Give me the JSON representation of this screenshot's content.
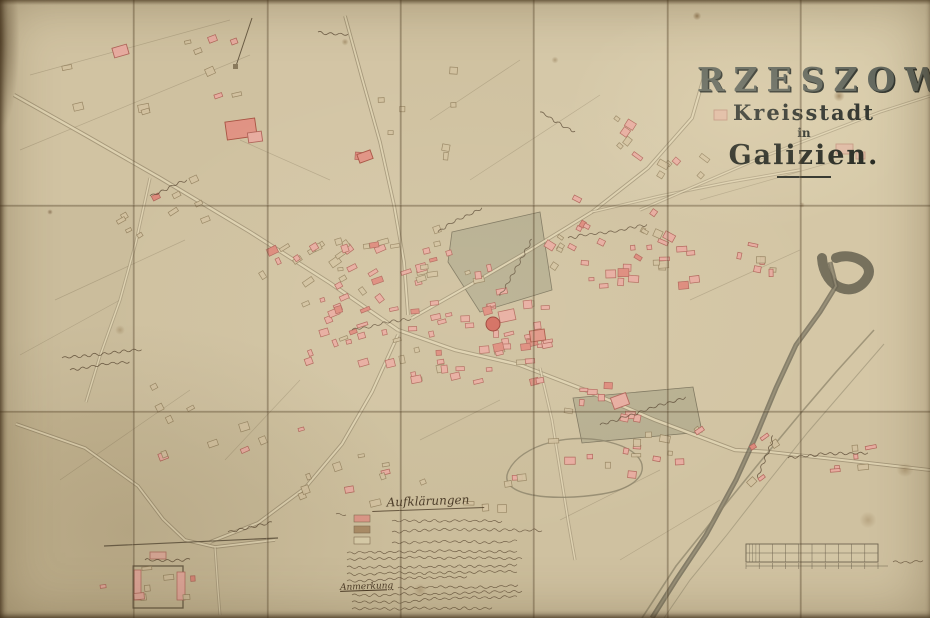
{
  "title": {
    "city": "RZESZOW",
    "subtitle": "Kreisstadt",
    "connector": "in",
    "region": "Galizien."
  },
  "legend": {
    "title": "Aufklärungen",
    "note_label": "Anmerkung",
    "swatches": [
      {
        "name": "masonry-building-swatch",
        "color": "#dd9486"
      },
      {
        "name": "wooden-building-swatch",
        "color": "#a98a64"
      },
      {
        "name": "outline-parcel-swatch",
        "color": "#d9cdaa"
      }
    ],
    "swatch_geo": [
      [
        354,
        515
      ],
      [
        354,
        526
      ],
      [
        354,
        537
      ]
    ],
    "lines": [
      [
        336,
        514,
        8
      ],
      [
        392,
        521,
        110
      ],
      [
        392,
        532,
        150
      ],
      [
        392,
        543,
        125
      ],
      [
        347,
        553,
        172
      ],
      [
        347,
        560,
        176
      ],
      [
        347,
        567,
        170
      ],
      [
        347,
        574,
        168
      ],
      [
        347,
        581,
        120
      ]
    ],
    "note_lines": [
      [
        398,
        588,
        118
      ],
      [
        352,
        595,
        168
      ],
      [
        352,
        602,
        166
      ],
      [
        352,
        609,
        140
      ]
    ]
  },
  "scale_bar": {
    "x": 746,
    "y": 544,
    "w": 132,
    "h": 18,
    "cols": 10,
    "label": [
      893,
      562,
      32
    ]
  },
  "colors": {
    "paper": "#cec09f",
    "ink": "#55432e",
    "road_fill": "#e3d7b6",
    "road_edge": "#8f8166",
    "river": "#6b6654",
    "stream": "#8a8168",
    "park": "#b2aa8d",
    "park_edge": "#7d755e",
    "masonry_fill": "#e7aca0",
    "masonry_edge": "#b0655a",
    "masonry_dark": "#dd8a7c",
    "wood_fill": "#d3c2a0",
    "wood_edge": "#93805e",
    "church_fill": "#d2685c",
    "church_edge": "#993c31"
  },
  "paper": {
    "cols": [
      0,
      133,
      267,
      400,
      533,
      667,
      800,
      930
    ],
    "rows": [
      0,
      205,
      411,
      618
    ],
    "panel_tints": [
      "#d1c3a2",
      "#cfc1a0",
      "#d3c5a5",
      "#d0c2a1",
      "#d5c8a8",
      "#d3c5a4",
      "#d7caa9",
      "#cbbd9c",
      "#cfc1a0",
      "#d1c3a2",
      "#cdbf9e",
      "#d0c2a1",
      "#d3c5a4",
      "#d5c7a6",
      "#c3b491",
      "#c9bb99",
      "#cdbf9d",
      "#cbbd9b",
      "#cfc1a0",
      "#d1c3a2",
      "#cfc1a0"
    ]
  },
  "map": {
    "roads": [
      {
        "pts": [
          [
            14,
            95
          ],
          [
            85,
            135
          ],
          [
            160,
            178
          ],
          [
            250,
            232
          ],
          [
            330,
            283
          ],
          [
            398,
            330
          ]
        ],
        "w": 3
      },
      {
        "pts": [
          [
            398,
            330
          ],
          [
            455,
            350
          ],
          [
            520,
            365
          ],
          [
            585,
            390
          ],
          [
            655,
            420
          ],
          [
            735,
            450
          ],
          [
            770,
            452
          ]
        ],
        "w": 3
      },
      {
        "pts": [
          [
            770,
            452
          ],
          [
            860,
            462
          ],
          [
            930,
            470
          ]
        ],
        "w": 2.6
      },
      {
        "pts": [
          [
            412,
            318
          ],
          [
            470,
            285
          ],
          [
            530,
            250
          ],
          [
            592,
            212
          ],
          [
            648,
            168
          ],
          [
            692,
            118
          ],
          [
            706,
            70
          ]
        ],
        "w": 2.6
      },
      {
        "pts": [
          [
            592,
            212
          ],
          [
            660,
            196
          ],
          [
            730,
            182
          ],
          [
            800,
            170
          ]
        ],
        "w": 2,
        "faint": 1
      },
      {
        "pts": [
          [
            640,
            210
          ],
          [
            760,
            158
          ],
          [
            880,
            112
          ],
          [
            930,
            96
          ]
        ],
        "w": 2,
        "faint": 1
      },
      {
        "pts": [
          [
            345,
            16
          ],
          [
            362,
            78
          ],
          [
            380,
            142
          ],
          [
            394,
            205
          ],
          [
            404,
            262
          ],
          [
            408,
            315
          ]
        ],
        "w": 2.4
      },
      {
        "pts": [
          [
            398,
            335
          ],
          [
            372,
            392
          ],
          [
            342,
            444
          ],
          [
            305,
            488
          ],
          [
            258,
            523
          ],
          [
            210,
            542
          ]
        ],
        "w": 2.6
      },
      {
        "pts": [
          [
            16,
            424
          ],
          [
            85,
            448
          ],
          [
            138,
            486
          ],
          [
            163,
            519
          ],
          [
            185,
            540
          ],
          [
            215,
            547
          ],
          [
            275,
            540
          ]
        ],
        "w": 2.4
      },
      {
        "pts": [
          [
            150,
            178
          ],
          [
            136,
            242
          ],
          [
            120,
            300
          ],
          [
            100,
            356
          ],
          [
            86,
            402
          ]
        ],
        "w": 2,
        "faint": 1
      },
      {
        "pts": [
          [
            540,
            368
          ],
          [
            552,
            420
          ],
          [
            560,
            470
          ],
          [
            568,
            520
          ],
          [
            575,
            560
          ]
        ],
        "w": 2,
        "faint": 1
      },
      {
        "pts": [
          [
            215,
            547
          ],
          [
            218,
            590
          ],
          [
            220,
            615
          ]
        ],
        "w": 1.8,
        "faint": 1
      }
    ],
    "river_main": [
      [
        830,
        262
      ],
      [
        836,
        286
      ],
      [
        820,
        312
      ],
      [
        796,
        345
      ],
      [
        776,
        388
      ],
      [
        756,
        436
      ],
      [
        736,
        480
      ],
      [
        706,
        535
      ],
      [
        676,
        580
      ],
      [
        652,
        618
      ]
    ],
    "river_bend": "M 822 258 C 824 290 856 300 868 276 C 874 262 850 252 836 258",
    "streams": [
      {
        "pts": [
          [
            874,
            330
          ],
          [
            836,
            372
          ],
          [
            800,
            414
          ],
          [
            760,
            462
          ],
          [
            716,
            516
          ],
          [
            676,
            566
          ],
          [
            642,
            618
          ]
        ],
        "w": 1.6,
        "op": 0.7
      },
      {
        "pts": [
          [
            884,
            344
          ],
          [
            846,
            388
          ],
          [
            808,
            432
          ],
          [
            768,
            482
          ],
          [
            726,
            536
          ],
          [
            690,
            580
          ],
          [
            664,
            618
          ]
        ],
        "w": 1,
        "op": 0.5
      }
    ],
    "oxbow": "M 508 472 C 520 444 574 430 616 444 C 654 456 652 486 602 494 C 552 502 498 496 508 472 Z",
    "parks": [
      {
        "pts": "452,232 540,212 552,290 480,312 448,262"
      },
      {
        "pts": "573,398 693,387 702,432 582,443"
      }
    ],
    "field_lines": [
      [
        30,
        75,
        230,
        20
      ],
      [
        20,
        150,
        250,
        55
      ],
      [
        55,
        300,
        185,
        240
      ],
      [
        20,
        355,
        120,
        300
      ],
      [
        60,
        480,
        190,
        390
      ],
      [
        225,
        460,
        300,
        380
      ],
      [
        430,
        120,
        520,
        60
      ],
      [
        470,
        180,
        600,
        95
      ],
      [
        700,
        200,
        840,
        160
      ],
      [
        690,
        300,
        800,
        250
      ],
      [
        560,
        520,
        660,
        470
      ],
      [
        420,
        440,
        500,
        400
      ],
      [
        240,
        140,
        330,
        180
      ],
      [
        620,
        560,
        720,
        500
      ]
    ],
    "clusters": [
      {
        "x": 398,
        "y": 300,
        "w": 150,
        "h": 80,
        "n": 48,
        "a": -8,
        "t": "m",
        "s": 11,
        "mix": 0.15
      },
      {
        "x": 258,
        "y": 240,
        "w": 120,
        "h": 55,
        "n": 22,
        "a": -30,
        "t": "m",
        "s": 22,
        "mix": 0.35
      },
      {
        "x": 300,
        "y": 295,
        "w": 105,
        "h": 68,
        "n": 22,
        "a": -18,
        "t": "m",
        "s": 33,
        "mix": 0.3
      },
      {
        "x": 330,
        "y": 222,
        "w": 110,
        "h": 62,
        "n": 15,
        "a": -14,
        "t": "w",
        "s": 44,
        "mix": 0.3
      },
      {
        "x": 545,
        "y": 195,
        "w": 120,
        "h": 70,
        "n": 18,
        "a": 30,
        "t": "m",
        "s": 55,
        "mix": 0.4
      },
      {
        "x": 610,
        "y": 105,
        "w": 95,
        "h": 70,
        "n": 12,
        "a": 35,
        "t": "w",
        "s": 66,
        "mix": 0.3
      },
      {
        "x": 580,
        "y": 232,
        "w": 115,
        "h": 52,
        "n": 18,
        "a": 0,
        "t": "m",
        "s": 77,
        "mix": 0.2
      },
      {
        "x": 545,
        "y": 432,
        "w": 150,
        "h": 42,
        "n": 14,
        "a": 4,
        "t": "m",
        "s": 88,
        "mix": 0.3
      },
      {
        "x": 560,
        "y": 382,
        "w": 90,
        "h": 40,
        "n": 9,
        "a": 6,
        "t": "m",
        "s": 99,
        "mix": 0.2
      },
      {
        "x": 295,
        "y": 415,
        "w": 130,
        "h": 85,
        "n": 12,
        "a": -16,
        "t": "w",
        "s": 111,
        "mix": 0.35
      },
      {
        "x": 148,
        "y": 378,
        "w": 115,
        "h": 85,
        "n": 10,
        "a": -24,
        "t": "w",
        "s": 122,
        "mix": 0.25
      },
      {
        "x": 62,
        "y": 34,
        "w": 200,
        "h": 85,
        "n": 11,
        "a": -18,
        "t": "w",
        "s": 133,
        "mix": 0.3
      },
      {
        "x": 105,
        "y": 160,
        "w": 135,
        "h": 80,
        "n": 10,
        "a": -28,
        "t": "w",
        "s": 144,
        "mix": 0.25
      },
      {
        "x": 415,
        "y": 248,
        "w": 85,
        "h": 48,
        "n": 10,
        "a": -12,
        "t": "m",
        "s": 155,
        "mix": 0.2
      },
      {
        "x": 335,
        "y": 58,
        "w": 120,
        "h": 95,
        "n": 9,
        "a": 4,
        "t": "w",
        "s": 166,
        "mix": 0.3
      },
      {
        "x": 695,
        "y": 425,
        "w": 80,
        "h": 55,
        "n": 7,
        "a": -38,
        "t": "m",
        "s": 177,
        "mix": 0.3
      },
      {
        "x": 455,
        "y": 462,
        "w": 85,
        "h": 48,
        "n": 6,
        "a": -6,
        "t": "w",
        "s": 188,
        "mix": 0.4
      },
      {
        "x": 700,
        "y": 238,
        "w": 70,
        "h": 40,
        "n": 7,
        "a": 5,
        "t": "m",
        "s": 199,
        "mix": 0.2
      },
      {
        "x": 95,
        "y": 552,
        "w": 100,
        "h": 52,
        "n": 8,
        "a": -4,
        "t": "m",
        "s": 211,
        "mix": 0.45
      },
      {
        "x": 826,
        "y": 443,
        "w": 85,
        "h": 30,
        "n": 6,
        "a": -6,
        "t": "m",
        "s": 222,
        "mix": 0.2
      }
    ],
    "landmarks": [
      {
        "x": 226,
        "y": 120,
        "w": 30,
        "h": 18,
        "r": -8,
        "t": "m2"
      },
      {
        "x": 248,
        "y": 132,
        "w": 14,
        "h": 10,
        "r": -8,
        "t": "m"
      },
      {
        "x": 113,
        "y": 46,
        "w": 15,
        "h": 10,
        "r": -16,
        "t": "m"
      },
      {
        "x": 358,
        "y": 152,
        "w": 14,
        "h": 9,
        "r": -20,
        "t": "m2"
      },
      {
        "x": 714,
        "y": 110,
        "w": 13,
        "h": 10,
        "r": 0,
        "t": "m",
        "op": 0.55
      },
      {
        "x": 836,
        "y": 144,
        "w": 17,
        "h": 10,
        "r": 0,
        "t": "m",
        "op": 0.5
      },
      {
        "x": 856,
        "y": 152,
        "w": 9,
        "h": 7,
        "r": 0,
        "t": "m",
        "op": 0.5
      },
      {
        "x": 612,
        "y": 395,
        "w": 16,
        "h": 12,
        "r": -20,
        "t": "m"
      },
      {
        "x": 530,
        "y": 330,
        "w": 15,
        "h": 11,
        "r": -8,
        "t": "m2"
      },
      {
        "x": 150,
        "y": 552,
        "w": 16,
        "h": 7,
        "r": 0,
        "t": "m",
        "op": 0.8
      }
    ],
    "church": {
      "cx": 493,
      "cy": 324,
      "r": 7,
      "rx": 498,
      "ry": 312,
      "rw": 16,
      "rh": 11
    },
    "enclosure": {
      "x": 133,
      "y": 566,
      "w": 50,
      "h": 42,
      "wall": [
        104,
        546,
        278,
        538
      ],
      "pink": [
        [
          134,
          570,
          7,
          30
        ],
        [
          177,
          572,
          8,
          28
        ]
      ]
    },
    "avenue": {
      "line": [
        252,
        18,
        236,
        66
      ],
      "sq": [
        233,
        64,
        5,
        5
      ]
    },
    "scripts": [
      {
        "x": 62,
        "y": 358,
        "len": 80,
        "a": -6,
        "s": 3
      },
      {
        "x": 70,
        "y": 370,
        "len": 60,
        "a": -6,
        "s": 4
      },
      {
        "x": 352,
        "y": 330,
        "len": 62,
        "a": -10,
        "s": 5
      },
      {
        "x": 500,
        "y": 296,
        "len": 66,
        "a": -64,
        "s": 6
      },
      {
        "x": 568,
        "y": 238,
        "len": 78,
        "a": -9,
        "s": 7
      },
      {
        "x": 600,
        "y": 425,
        "len": 92,
        "a": -17,
        "s": 8
      },
      {
        "x": 758,
        "y": 478,
        "len": 46,
        "a": -70,
        "s": 9
      },
      {
        "x": 788,
        "y": 458,
        "len": 78,
        "a": -4,
        "s": 10
      },
      {
        "x": 145,
        "y": 560,
        "len": 46,
        "a": -2,
        "s": 12
      },
      {
        "x": 228,
        "y": 532,
        "len": 44,
        "a": -14,
        "s": 13
      },
      {
        "x": 150,
        "y": 196,
        "len": 38,
        "a": -22,
        "s": 14
      },
      {
        "x": 540,
        "y": 112,
        "len": 40,
        "a": 28,
        "s": 15
      },
      {
        "x": 438,
        "y": 232,
        "len": 50,
        "a": -30,
        "s": 16
      },
      {
        "x": 318,
        "y": 32,
        "len": 30,
        "a": 8,
        "s": 17
      }
    ]
  }
}
